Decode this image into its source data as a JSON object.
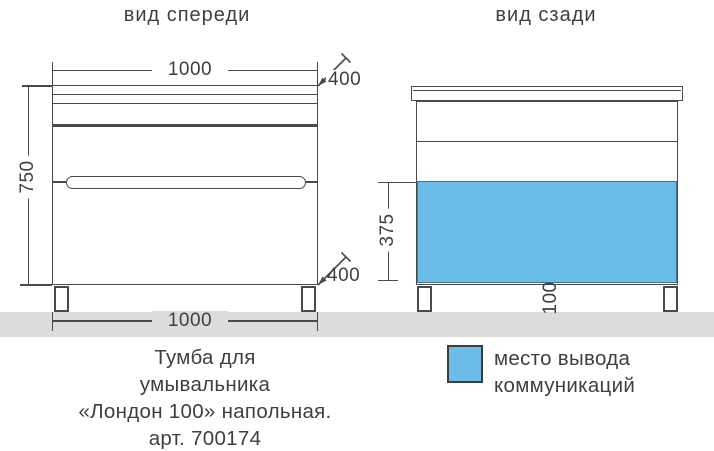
{
  "views": {
    "front": {
      "title": "вид спереди",
      "dims": {
        "width_top": "1000",
        "depth_top": "400",
        "height": "750",
        "depth_bottom": "400",
        "width_bottom": "1000"
      }
    },
    "back": {
      "title": "вид сзади",
      "dims": {
        "comm_zone_height": "375",
        "leg_zone": "100"
      }
    }
  },
  "caption": {
    "lines": [
      "Тумба для",
      "умывальника",
      "«Лондон 100» напольная.",
      "арт. 700174"
    ]
  },
  "legend": {
    "lines": [
      "место вывода",
      "коммуникаций"
    ]
  },
  "colors": {
    "line": "#4a4a4a",
    "text": "#3f3f3f",
    "floor": "#dcdcdc",
    "highlight_fill": "#6cbce8",
    "highlight_border": "#41749b"
  }
}
